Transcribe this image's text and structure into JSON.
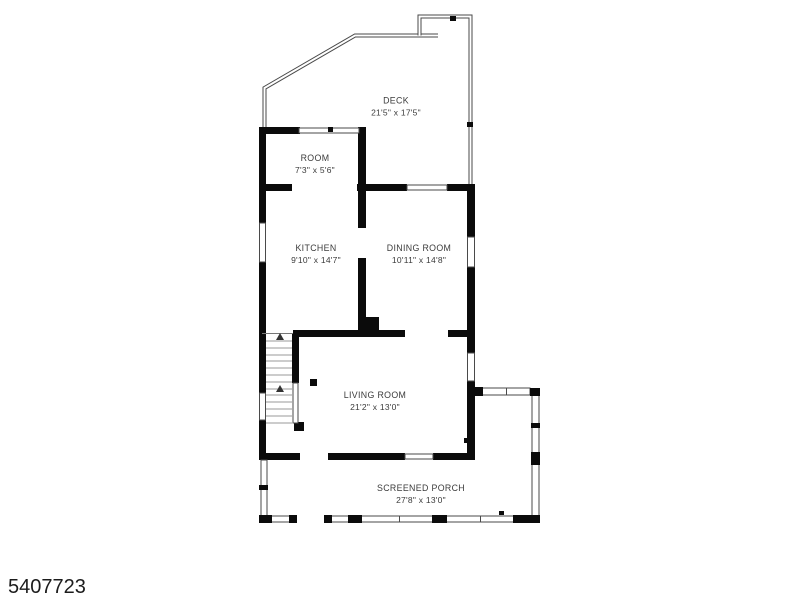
{
  "title": "Floor plan",
  "watermark": "5407723",
  "colors": {
    "wall": "#0b0b0b",
    "railing": "#4a4a4a",
    "label": "#3b3b3b",
    "watermark": "#1c1c1c",
    "background": "#ffffff"
  },
  "rooms": [
    {
      "name": "DECK",
      "dims": "21'5\" x 17'5\""
    },
    {
      "name": "ROOM",
      "dims": "7'3\" x 5'6\""
    },
    {
      "name": "KITCHEN",
      "dims": "9'10\" x 14'7\""
    },
    {
      "name": "DINING ROOM",
      "dims": "10'11\" x 14'8\""
    },
    {
      "name": "LIVING ROOM",
      "dims": "21'2\" x 13'0\""
    },
    {
      "name": "SCREENED PORCH",
      "dims": "27'8\" x 13'0\""
    }
  ]
}
